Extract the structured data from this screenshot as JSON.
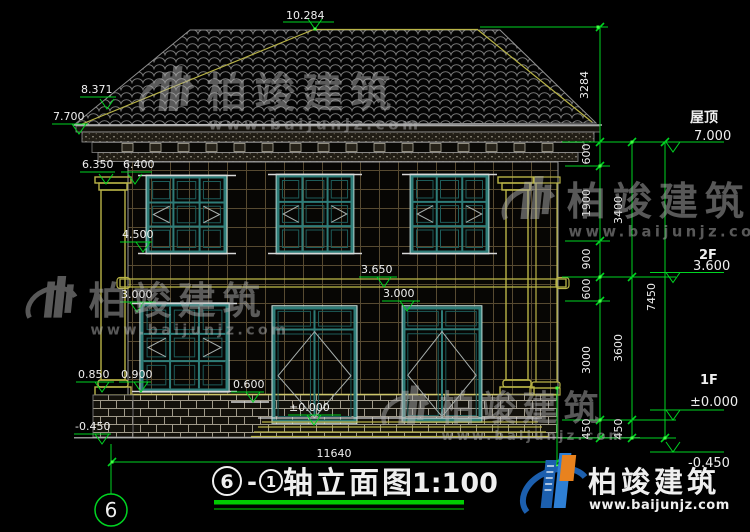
{
  "colors": {
    "background": "#000000",
    "dim_green": "#00d422",
    "accent_yellow": "#b9b447",
    "frame_teal": "#2e7c78",
    "text_white": "#efefef",
    "title_underline": "#00cc00",
    "logo_blue": "#1c5fae",
    "logo_orange": "#e8821e",
    "watermark_gray": "#b0b0b0"
  },
  "watermark": {
    "brand": "柏竣建筑",
    "url": "www.baijunjz.com"
  },
  "logo": {
    "brand": "柏竣建筑",
    "url": "www.baijunjz.com"
  },
  "title": {
    "axis_a": "6",
    "separator": "-",
    "axis_b": "1",
    "name": "轴立面图",
    "scale": "1:100"
  },
  "axis_bubble": {
    "label": "6"
  },
  "levels": {
    "roof_label": "屋顶",
    "roof_value": "7.000",
    "f2_label": "2F",
    "f2_value": "3.600",
    "f1_label": "1F",
    "f1_value": "±0.000",
    "below_value": "-0.450"
  },
  "dims": {
    "overall_width": "11640",
    "ridge": "10.284",
    "hip": "8.371",
    "eave": "7.700",
    "cap_left": "6.350",
    "wall_top": "6.400",
    "sill_2f": "4.500",
    "band_top": "3.650",
    "ceiling_mid": "3.000",
    "window_top_1f": "3.000",
    "base_cap": "0.850",
    "plinth": "0.900",
    "porch": "0.600",
    "floor": "±0.000",
    "ground": "-0.450",
    "right_col1": [
      "3284",
      "600",
      "1900",
      "900",
      "600",
      "3000",
      "450"
    ],
    "right_col2": [
      "3400",
      "3600",
      "450"
    ],
    "right_total": "7450"
  }
}
